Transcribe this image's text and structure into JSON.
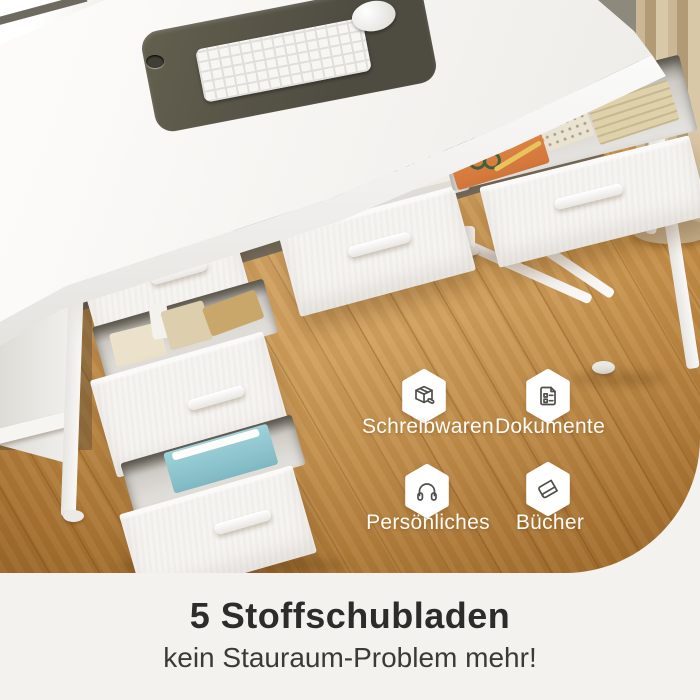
{
  "photo": {
    "alt": "White desk with five open white fabric drawers filled with office supplies, on a wood floor with a beige curtain at the right",
    "badges": [
      {
        "label": "Schreibwaren",
        "icon": "package-box-icon"
      },
      {
        "label": "Dokumente",
        "icon": "document-icon"
      },
      {
        "label": "Persönliches",
        "icon": "headphones-icon"
      },
      {
        "label": "Bücher",
        "icon": "book-icon"
      }
    ]
  },
  "caption": {
    "title": "5 Stoffschubladen",
    "subtitle": "kein Stauraum-Problem mehr!"
  },
  "colors": {
    "band_bg": "#f3f2ef",
    "heading": "#2c2c2a",
    "subheading": "#3a3a37",
    "label": "#fffdf6",
    "icon": "#514e48",
    "wood": "#c8944e",
    "wood_dark": "#a96f2c",
    "curtain": "#c3ae8c",
    "desk_white": "#f7f5f2",
    "mat": "#56534a",
    "accent_orange": "#dd8047",
    "accent_blue": "#93c8d1",
    "headphone_tan": "#b57c4a"
  }
}
